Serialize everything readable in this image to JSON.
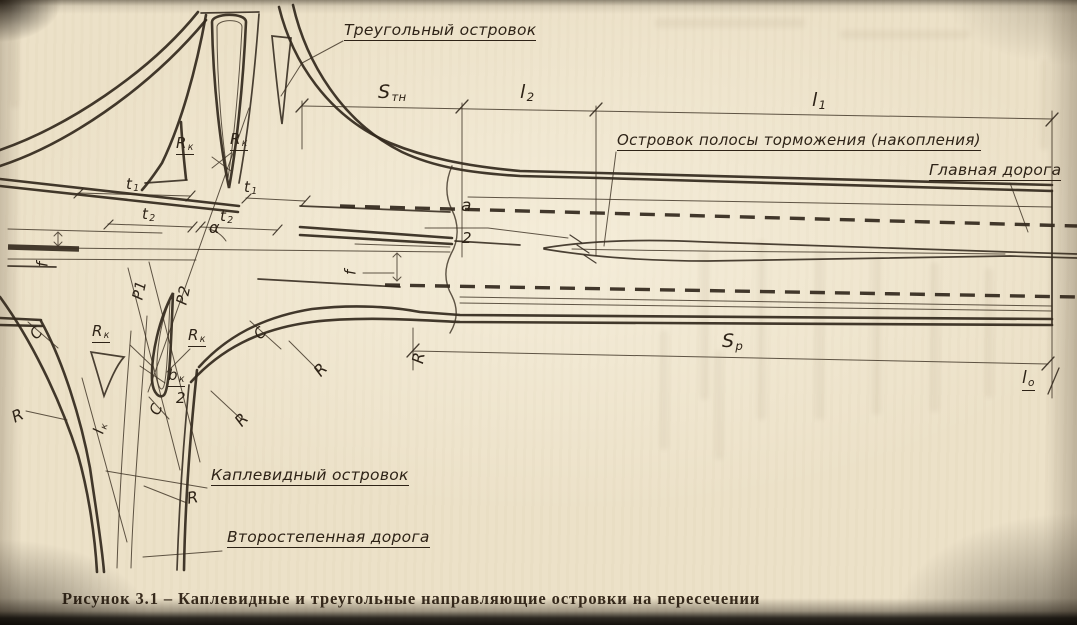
{
  "figure": {
    "caption": "Рисунок 3.1 – Каплевидные и треугольные направляющие островки на пересечении"
  },
  "labels": {
    "triangular_island": "Треугольный островок",
    "braking_lane_island": "Островок полосы торможения (накопления)",
    "main_road": "Главная дорога",
    "teardrop_island": "Каплевидный островок",
    "secondary_road": "Второстепенная дорога"
  },
  "dimensions": {
    "s_tn": {
      "base": "S",
      "sub": "тн"
    },
    "l1": {
      "base": "l",
      "sub": "1"
    },
    "l2": {
      "base": "l",
      "sub": "2"
    },
    "sp": {
      "base": "S",
      "sub": "p"
    },
    "lo": {
      "base": "l",
      "sub": "о"
    },
    "t1": {
      "base": "t",
      "sub": "1"
    },
    "t2": {
      "base": "t",
      "sub": "2"
    },
    "a_half": {
      "numerator": "a",
      "denominator": "2"
    },
    "b_half": {
      "numerator_base": "b",
      "numerator_sub": "к",
      "denominator": "2"
    },
    "alpha": "α",
    "f": "f",
    "r_k": {
      "base": "R",
      "sub": "к"
    },
    "r": "R",
    "c": "C",
    "l_k": {
      "base": "l",
      "sub": "к"
    },
    "p1": "Р1",
    "p2": "Р2"
  },
  "colors": {
    "paper": "#ece1c8",
    "ink": "#32281c"
  }
}
